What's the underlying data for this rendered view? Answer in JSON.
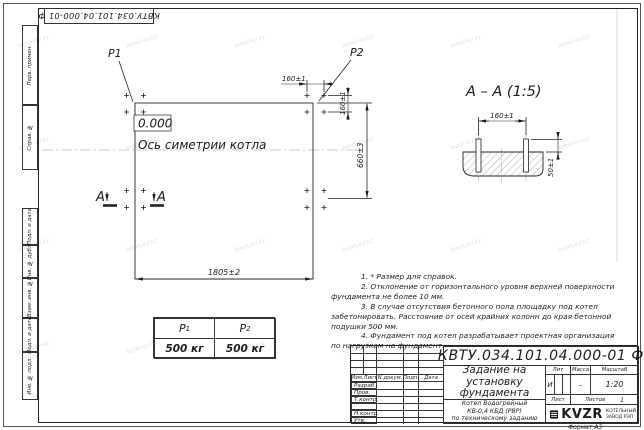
{
  "sheet": {
    "corner_designation": "КВТУ.034.101.04.000-01 Ф",
    "format_note": "Формат А3",
    "watermark": "kotel-kv.kz"
  },
  "stamp_column": {
    "cell1": "Перв. примен.",
    "cell2": "Справ. №",
    "cell3": "Подп. и дата",
    "cell4": "Инв. № дубл.",
    "cell5": "Взам. инв. №",
    "cell6": "Подп. и дата",
    "cell7": "Инв. № подл."
  },
  "plan": {
    "load_point_1": "Р1",
    "load_point_2": "Р2",
    "level_mark": "0.000",
    "axis_label": "Ось симетрии котла",
    "section_letter_left": "А",
    "section_letter_right": "А",
    "dim_bolt_h": "160±1",
    "dim_bolt_v": "160±1",
    "dim_length": "1805±2",
    "dim_width": "660±3"
  },
  "section_view": {
    "title": "А – А (1:5)",
    "dim_bolt": "160±1",
    "dim_height": "50±1"
  },
  "notes": {
    "n1": "1. * Размер для справок.",
    "n2": "2. Отклонение от горизонтального уровня верхней поверхности фундамента не более 10 мм.",
    "n3": "3. В случае отсутствия бетонного пола площадку под котел забетонировать. Расстояние от осей крайних колонн до края бетонной подушки 500 мм.",
    "n4": "4. Фундамент под котел разрабатывает проектная организация по нагрузкам на фундамент."
  },
  "load_table": {
    "col1_header": "Р",
    "col1_sub": "1",
    "col2_header": "Р",
    "col2_sub": "2",
    "col1_value": "500 кг",
    "col2_value": "500 кг"
  },
  "title_block": {
    "designation": "КВТУ.034.101.04.000-01 Ф",
    "doc_title_line1": "Задание на",
    "doc_title_line2": "установку",
    "doc_title_line3": "фундамента",
    "product_line1": "Котел Водогрейный",
    "product_line2": "КВ-0,4 КБД (РВР)",
    "product_line3": "по техническому заданию",
    "head_col1": "Изм.Лист",
    "head_col2": "N докум.",
    "head_col3": "Подп.",
    "head_col4": "Дата",
    "row1": "Разраб.",
    "row2": "Пров.",
    "row3": "Т.контр.",
    "row4": "",
    "row5": "Н.контр.",
    "row6": "Утв.",
    "lit_label": "Лит",
    "mass_label": "Масса",
    "scale_label": "Масштаб",
    "lit_value": "И",
    "mass_value": "–",
    "scale_value": "1:20",
    "sheet_label": "Лист",
    "sheets_label": "Листов",
    "sheets_value": "1",
    "logo_text": "KVZR",
    "logo_sub1": "КОТЕЛЬНЫЙ",
    "logo_sub2": "ЗАВОД РЭП"
  }
}
